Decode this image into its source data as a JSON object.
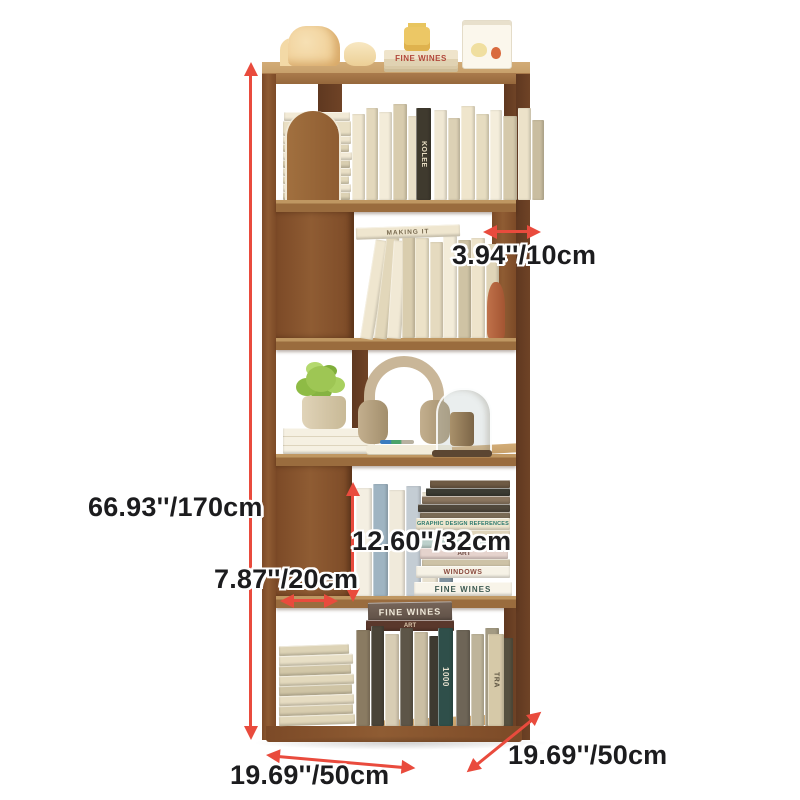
{
  "colors": {
    "background": "#ffffff",
    "arrow": "#e94b3d",
    "label_text": "#1c1c1e",
    "wood_top": "#c7a06a",
    "wood_front": "#9a6c3e",
    "wood_side": "#8a5630",
    "wood_dark": "#6b3d1f",
    "book_cream": "#ece2c9",
    "plant_green": "#9ec654",
    "headphones_tan": "#c9b698",
    "vase_terracotta": "#b26038"
  },
  "dimension_labels": {
    "total_height": "66.93''/170cm",
    "panel_depth": "3.94''/10cm",
    "shelf_inner_height": "12.60''/32cm",
    "side_panel_width": "7.87''/20cm",
    "base_width_left": "19.69''/50cm",
    "base_width_right": "19.69''/50cm"
  },
  "books": {
    "top_decor_stack": "FINE WINES",
    "tier1_stack_top": "CHO",
    "tier1_stack_title": "1984-2003",
    "tier1_dark_spine": "KOLEE",
    "tier2_flat_book": "MAKING IT",
    "tier4_reference": "GRAPHIC DESIGN REFERENCES",
    "tier4_art": "ART",
    "tier4_windows": "WINDOWS",
    "tier4_fine_wines": "FINE WINES",
    "tier5_fine_wines": "FINE WINES",
    "tier5_art": "ART",
    "tier5_dark_spine": "1000",
    "tier5_right_spine": "TRA"
  }
}
